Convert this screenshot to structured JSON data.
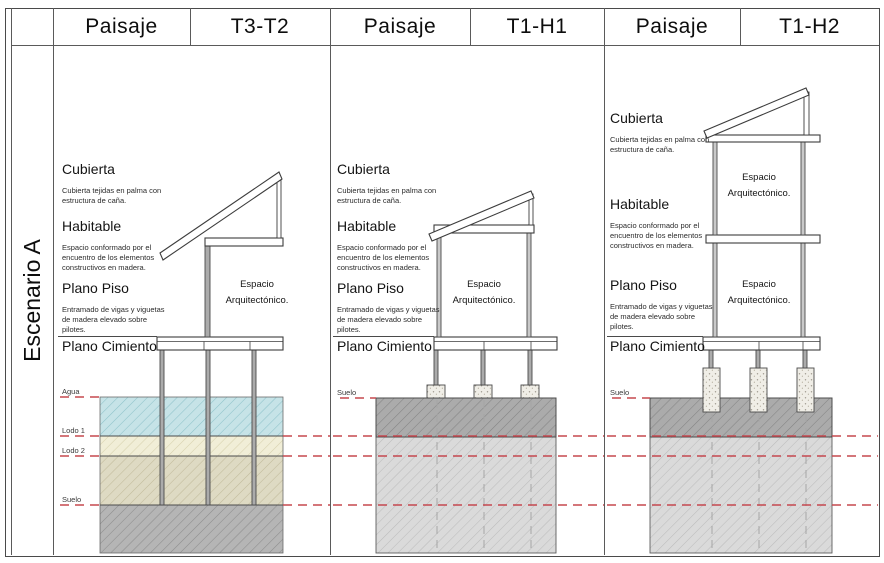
{
  "scenario": {
    "label": "Escenario A"
  },
  "panels": [
    {
      "paisaje": "Paisaje",
      "code": "T3-T2",
      "sections": {
        "cubierta": {
          "title": "Cubierta",
          "desc": "Cubierta tejidas en palma con estructura de caña."
        },
        "habitable": {
          "title": "Habitable",
          "desc": "Espacio conformado por el encuentro de los elementos constructivos en madera."
        },
        "plano_piso": {
          "title": "Plano Piso",
          "desc": "Entramado de vigas y viguetas de madera elevado sobre pilotes."
        },
        "plano_cimiento": {
          "title": "Plano Cimiento"
        }
      },
      "space_label": "Espacio Arquitectónico.",
      "ground_labels": {
        "agua": "Agua",
        "lodo1": "Lodo 1",
        "lodo2": "Lodo 2",
        "suelo": "Suelo"
      }
    },
    {
      "paisaje": "Paisaje",
      "code": "T1-H1",
      "sections": {
        "cubierta": {
          "title": "Cubierta",
          "desc": "Cubierta tejidas en palma con estructura de caña."
        },
        "habitable": {
          "title": "Habitable",
          "desc": "Espacio conformado por el encuentro de los elementos constructivos en madera."
        },
        "plano_piso": {
          "title": "Plano Piso",
          "desc": "Entramado de vigas y viguetas de madera elevado sobre pilotes."
        },
        "plano_cimiento": {
          "title": "Plano Cimiento"
        }
      },
      "space_label": "Espacio Arquitectónico.",
      "ground_labels": {
        "suelo": "Suelo"
      }
    },
    {
      "paisaje": "Paisaje",
      "code": "T1-H2",
      "sections": {
        "cubierta": {
          "title": "Cubierta",
          "desc": "Cubierta tejidas en palma con estructura de caña."
        },
        "habitable": {
          "title": "Habitable",
          "desc": "Espacio conformado por el encuentro de los elementos constructivos en madera."
        },
        "plano_piso": {
          "title": "Plano Piso",
          "desc": "Entramado de vigas y viguetas de madera elevado sobre pilotes."
        },
        "plano_cimiento": {
          "title": "Plano Cimiento"
        }
      },
      "space_label": "Espacio Arquitectónico.",
      "ground_labels": {
        "suelo": "Suelo"
      }
    }
  ],
  "colors": {
    "water": "#c6e3e7",
    "lodo1": "#f1eed7",
    "lodo2": "#dedac3",
    "soil_gray": "#b5b5b5",
    "soil_dark_band": "#ababab",
    "soil_light": "#dadada",
    "red_datum_line": "#c5484f"
  }
}
